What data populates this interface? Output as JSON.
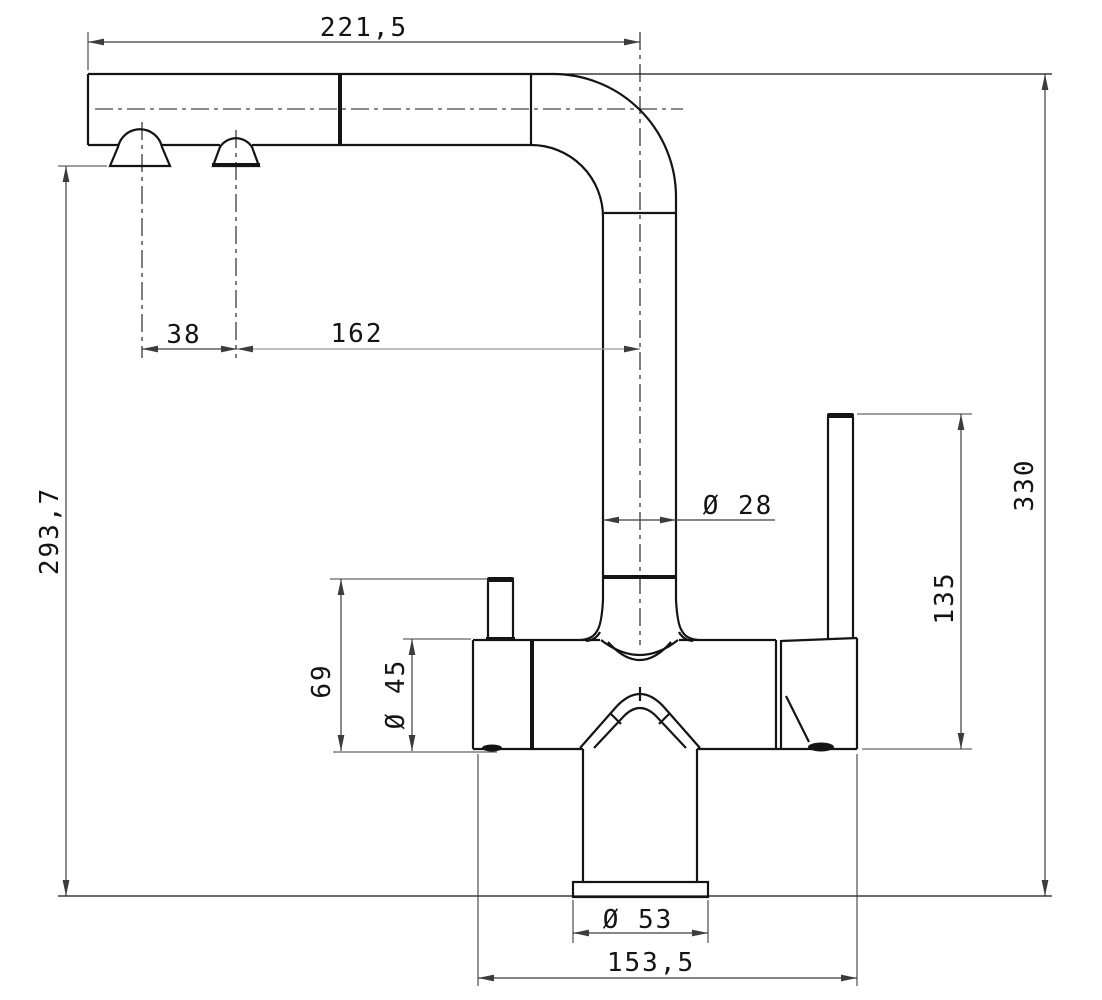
{
  "drawing": {
    "subject": "kitchen-faucet-side-elevation-technical-drawing",
    "background": "#ffffff",
    "line_color": "#141414",
    "dim_color": "#3c3c3c",
    "dimensions": {
      "spout_reach": "221,5",
      "outlet_spacing": "38",
      "outlet_to_axis": "162",
      "outlet_height": "293,7",
      "pipe_diameter": "Ø 28",
      "total_height": "330",
      "handle_span": "135",
      "side_knob_height": "69",
      "body_diameter": "Ø 45",
      "base_flange_diameter": "Ø 53",
      "base_span": "153,5"
    }
  }
}
